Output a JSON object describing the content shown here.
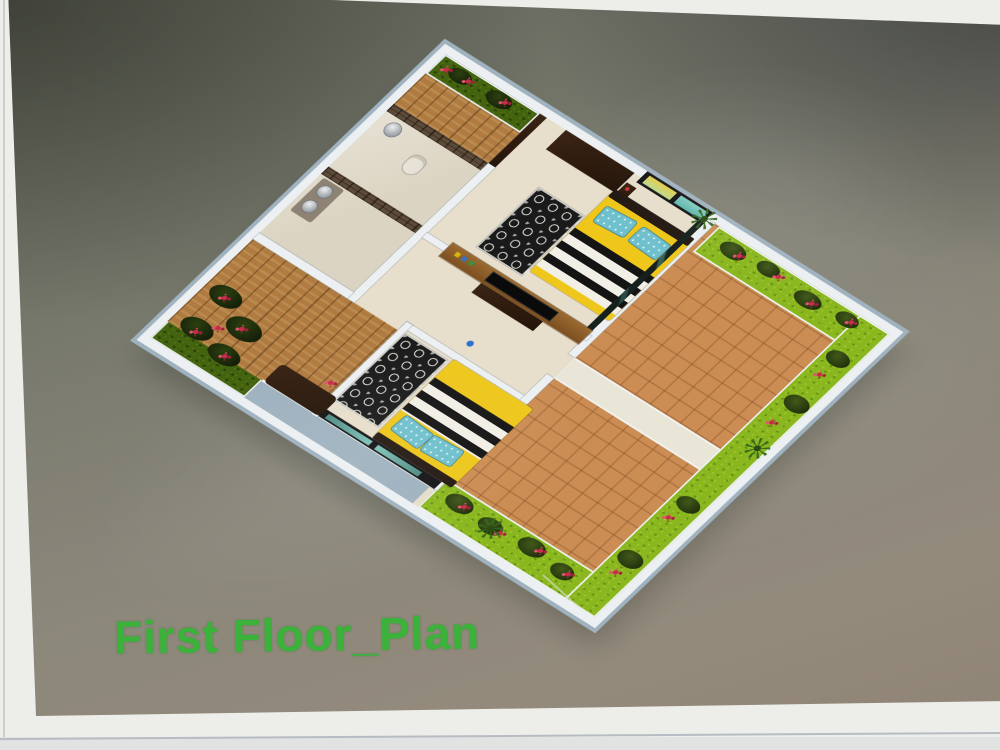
{
  "photo": {
    "type": "photograph-of-printed-3d-floor-plan",
    "caption": "First Floor_Plan"
  },
  "palette": {
    "caption-green": "#3bb33b",
    "paper-white": "#edeeea",
    "print-bg-dark": "#5a5d52",
    "print-bg-light": "#948a7c",
    "parapet-white": "#ecf0f2",
    "wall-face-blue": "#9fb2bf",
    "floor-cream": "#e7decb",
    "terrace-tile": "#cb8d53",
    "lawn-green": "#8ab71e",
    "garden-dark-green": "#2c3f10",
    "flower-red": "#c92c4a",
    "wood-brown": "#b07b40",
    "tv-panel-wood": "#8a5a28",
    "stone-wall": "#5d4b3a",
    "bed-yellow": "#eec71a",
    "blanket-black": "#141414",
    "blanket-white": "#f2efe6",
    "pillow-teal": "#6fc0cd",
    "glass-dark": "#1d2724",
    "marble-beige": "#dcd4c2"
  },
  "scene": {
    "rooms": [
      {
        "name": "bathroom-top",
        "features": [
          "stone-accent-wall",
          "wash-basin",
          "toilet"
        ]
      },
      {
        "name": "bathroom-left",
        "features": [
          "stone-accent-wall",
          "double-wash-basin",
          "vanity-counter"
        ]
      },
      {
        "name": "bedroom-upper",
        "features": [
          "yellow-bed",
          "striped-blanket",
          "teal-pillows",
          "patterned-rug",
          "curtained-window",
          "wardrobe",
          "glass-partition"
        ]
      },
      {
        "name": "living-area",
        "features": [
          "tv-panel-wall",
          "tv",
          "tv-stand",
          "shelf-decor"
        ]
      },
      {
        "name": "bedroom-lower",
        "features": [
          "yellow-bed",
          "striped-blanket",
          "teal-pillows",
          "patterned-rug",
          "glass-wall"
        ]
      },
      {
        "name": "terrace-right",
        "features": [
          "terracotta-tiles",
          "l-shaped-lawn",
          "hedge-row",
          "red-flowers",
          "white-parapet",
          "palm-plant",
          "white-path"
        ]
      },
      {
        "name": "terrace-bottom",
        "features": [
          "terracotta-tiles",
          "lawn-strip",
          "hedge-row",
          "red-flowers",
          "palm-plant"
        ]
      },
      {
        "name": "garden-left-corner",
        "features": [
          "dense-shrubs",
          "red-flowers"
        ]
      },
      {
        "name": "entry-walkway",
        "features": [
          "wooden-deck",
          "flower-planter",
          "door-frame",
          "bench"
        ]
      }
    ]
  }
}
